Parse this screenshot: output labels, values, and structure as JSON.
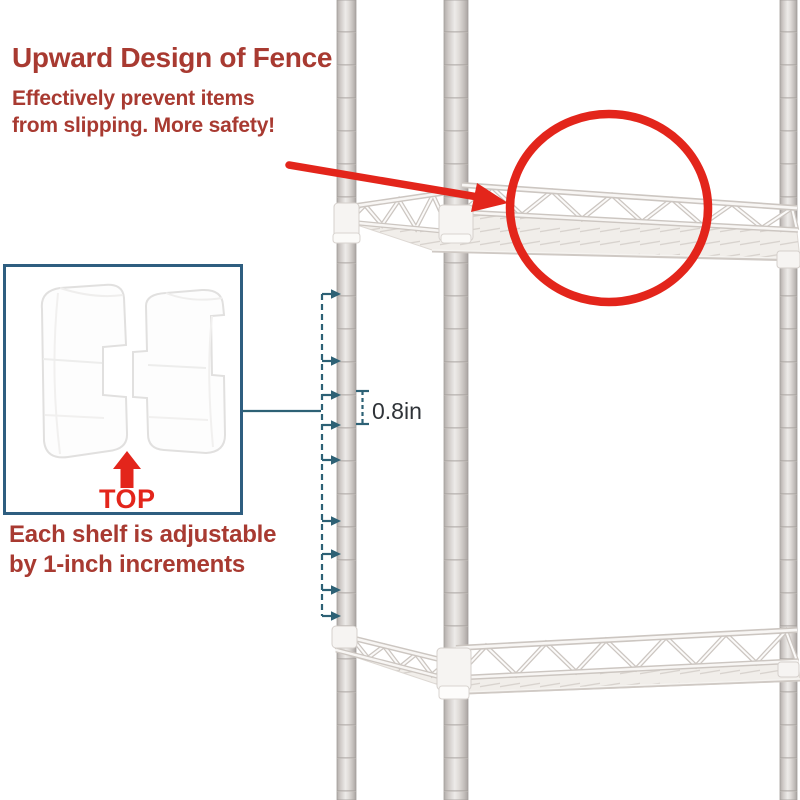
{
  "annotations": {
    "fence_callout": {
      "title": "Upward Design of Fence",
      "subtitle_line1": "Effectively prevent items",
      "subtitle_line2": "from slipping. More safety!"
    },
    "clip_inset": {
      "label": "TOP"
    },
    "adjustability_note": {
      "line1": "Each shelf is adjustable",
      "line2": "by 1-inch increments"
    },
    "measurement": {
      "increment_label": "0.8in"
    }
  },
  "colors": {
    "callout_text_red": "#a83a31",
    "highlight_red": "#e3251b",
    "inset_border_blue": "#2e5e80",
    "measure_teal": "#2d6175",
    "measure_label_dark": "#2f3338",
    "pole_gray": "#d6d1ce",
    "shelf_ivory": "#f1eeea",
    "background": "#ffffff"
  }
}
